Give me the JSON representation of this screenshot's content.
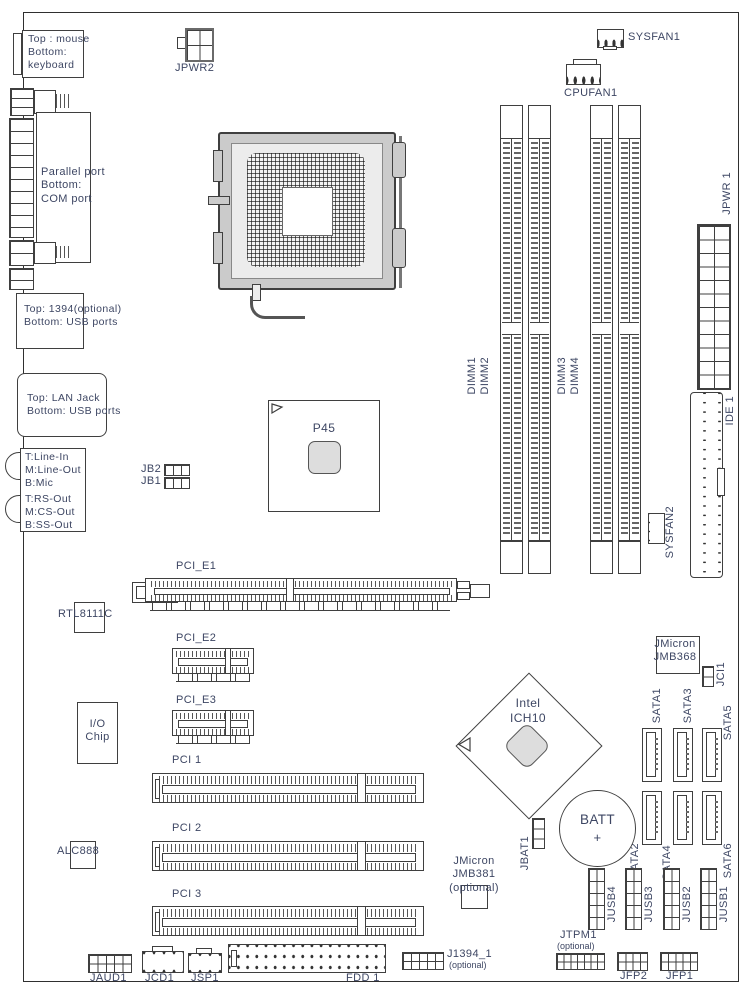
{
  "diagram_title": "Motherboard layout diagram",
  "colors": {
    "label_text": "#3d4663",
    "line": "#3f3f3f",
    "socket_gray": "#cbcbcb",
    "pad_gray": "#e0e0e0"
  },
  "back_panel": {
    "ps2": "Top : mouse\nBottom:\nkeyboard",
    "parallel": "Parallel port\nBottom:\nCOM port",
    "fw_usb": "Top: 1394(optional)\nBottom: USB ports",
    "lan_usb": "Top: LAN Jack\nBottom: USB ports",
    "audio_top": "T:Line-In\nM:Line-Out\nB:Mic",
    "audio_bottom": "T:RS-Out\nM:CS-Out\nB:SS-Out"
  },
  "power": {
    "jpwr2": "JPWR2",
    "jpwr1": "JPWR 1"
  },
  "fans": {
    "sysfan1": "SYSFAN1",
    "cpufan1": "CPUFAN1",
    "sysfan2": "SYSFAN2"
  },
  "chips": {
    "northbridge": "P45",
    "southbridge": "Intel\nICH10",
    "lan": "RTL8111C",
    "io": "I/O\nChip",
    "audio": "ALC888",
    "jmb368": "JMicron\nJMB368",
    "jmb381": "JMicron\nJMB381\n(optional)"
  },
  "memory": {
    "dimm1": "DIMM1",
    "dimm2": "DIMM2",
    "dimm3": "DIMM3",
    "dimm4": "DIMM4"
  },
  "slots": {
    "pcie1": "PCI_E1",
    "pcie2": "PCI_E2",
    "pcie3": "PCI_E3",
    "pci1": "PCI 1",
    "pci2": "PCI 2",
    "pci3": "PCI 3"
  },
  "storage": {
    "ide1": "IDE 1",
    "fdd1": "FDD 1",
    "sata": [
      "SATA1",
      "SATA2",
      "SATA3",
      "SATA4",
      "SATA5",
      "SATA6"
    ]
  },
  "battery": {
    "batt": "BATT",
    "plus": "+",
    "jbat1": "JBAT1"
  },
  "headers": {
    "jb2": "JB2",
    "jb1": "JB1",
    "jci1": "JCI1",
    "jusb4": "JUSB4",
    "jusb3": "JUSB3",
    "jusb2": "JUSB2",
    "jusb1": "JUSB1",
    "jtpm1": "JTPM1",
    "jtpm1_opt": "(optional)",
    "jfp2": "JFP2",
    "jfp1": "JFP1",
    "j1394": "J1394_1",
    "j1394_opt": "(optional)",
    "jaud1": "JAUD1",
    "jcd1": "JCD1",
    "jsp1": "JSP1"
  }
}
